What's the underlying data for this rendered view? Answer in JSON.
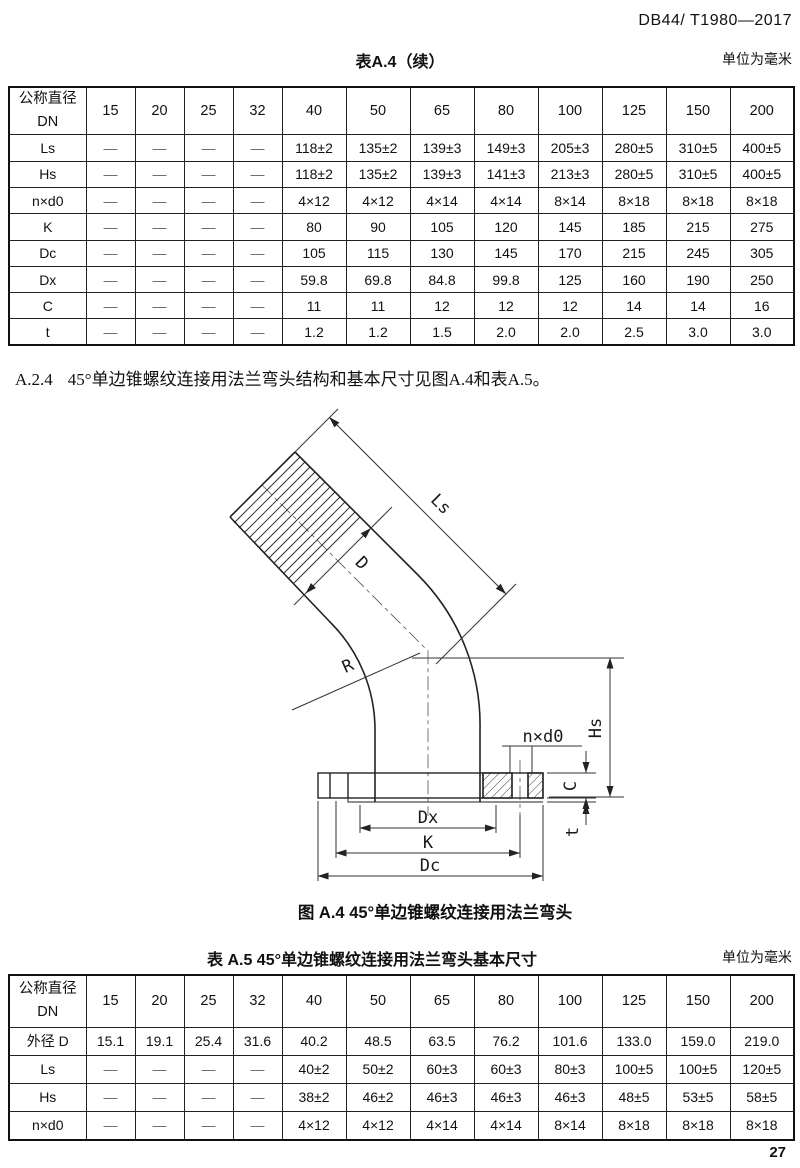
{
  "page": {
    "header_code": "DB44/ T1980—2017",
    "page_number": "27"
  },
  "tableA4": {
    "title": "表A.4（续）",
    "unit_note": "单位为毫米",
    "header": [
      "公称直径\nDN",
      "15",
      "20",
      "25",
      "32",
      "40",
      "50",
      "65",
      "80",
      "100",
      "125",
      "150",
      "200"
    ],
    "rows": [
      [
        "Ls",
        "—",
        "—",
        "—",
        "—",
        "118±2",
        "135±2",
        "139±3",
        "149±3",
        "205±3",
        "280±5",
        "310±5",
        "400±5"
      ],
      [
        "Hs",
        "—",
        "—",
        "—",
        "—",
        "118±2",
        "135±2",
        "139±3",
        "141±3",
        "213±3",
        "280±5",
        "310±5",
        "400±5"
      ],
      [
        "n×d0",
        "—",
        "—",
        "—",
        "—",
        "4×12",
        "4×12",
        "4×14",
        "4×14",
        "8×14",
        "8×18",
        "8×18",
        "8×18"
      ],
      [
        "K",
        "—",
        "—",
        "—",
        "—",
        "80",
        "90",
        "105",
        "120",
        "145",
        "185",
        "215",
        "275"
      ],
      [
        "Dc",
        "—",
        "—",
        "—",
        "—",
        "105",
        "115",
        "130",
        "145",
        "170",
        "215",
        "245",
        "305"
      ],
      [
        "Dx",
        "—",
        "—",
        "—",
        "—",
        "59.8",
        "69.8",
        "84.8",
        "99.8",
        "125",
        "160",
        "190",
        "250"
      ],
      [
        "C",
        "—",
        "—",
        "—",
        "—",
        "11",
        "11",
        "12",
        "12",
        "12",
        "14",
        "14",
        "16"
      ],
      [
        "t",
        "—",
        "—",
        "—",
        "—",
        "1.2",
        "1.2",
        "1.5",
        "2.0",
        "2.0",
        "2.5",
        "3.0",
        "3.0"
      ]
    ]
  },
  "clause": {
    "number": "A.2.4",
    "text": "45°单边锥螺纹连接用法兰弯头结构和基本尺寸见图A.4和表A.5。"
  },
  "figure": {
    "caption": "图 A.4  45°单边锥螺纹连接用法兰弯头",
    "labels": {
      "ls": "Ls",
      "d": "D",
      "r": "R",
      "hs": "Hs",
      "nxd0": "n×d0",
      "c": "C",
      "t": "t",
      "dx": "Dx",
      "k": "K",
      "dc": "Dc"
    }
  },
  "tableA5": {
    "title": "表 A.5  45°单边锥螺纹连接用法兰弯头基本尺寸",
    "unit_note": "单位为毫米",
    "header": [
      "公称直径\nDN",
      "15",
      "20",
      "25",
      "32",
      "40",
      "50",
      "65",
      "80",
      "100",
      "125",
      "150",
      "200"
    ],
    "rows": [
      [
        "外径 D",
        "15.1",
        "19.1",
        "25.4",
        "31.6",
        "40.2",
        "48.5",
        "63.5",
        "76.2",
        "101.6",
        "133.0",
        "159.0",
        "219.0"
      ],
      [
        "Ls",
        "—",
        "—",
        "—",
        "—",
        "40±2",
        "50±2",
        "60±3",
        "60±3",
        "80±3",
        "100±5",
        "100±5",
        "120±5"
      ],
      [
        "Hs",
        "—",
        "—",
        "—",
        "—",
        "38±2",
        "46±2",
        "46±3",
        "46±3",
        "46±3",
        "48±5",
        "53±5",
        "58±5"
      ],
      [
        "n×d0",
        "—",
        "—",
        "—",
        "—",
        "4×12",
        "4×12",
        "4×14",
        "4×14",
        "8×14",
        "8×18",
        "8×18",
        "8×18"
      ]
    ]
  }
}
